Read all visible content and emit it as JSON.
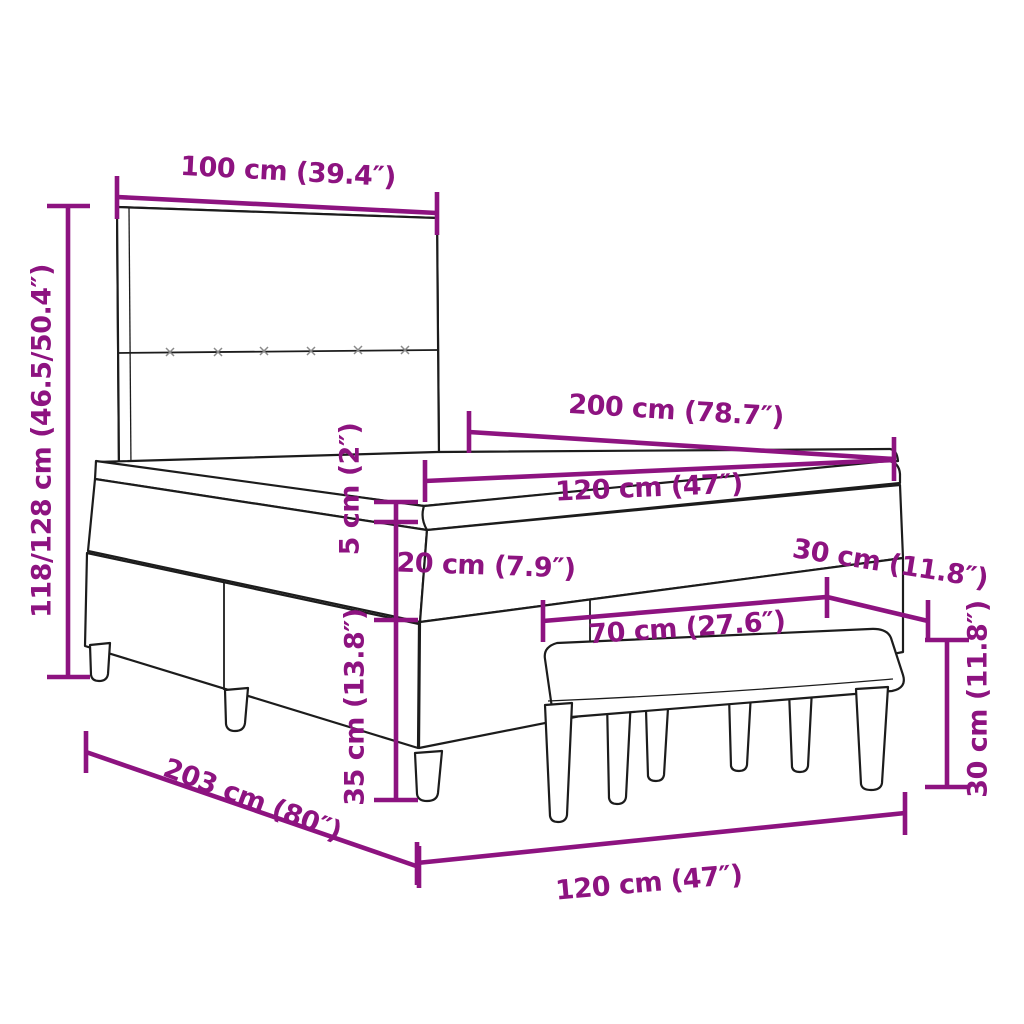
{
  "diagram": {
    "title": "Box spring bed with headboard, mattress topper and bench — dimension diagram",
    "colors": {
      "dimension_accent": "#8d1380",
      "outline": "#1c1c1c",
      "background": "#ffffff"
    },
    "dimensions": {
      "headboard_width": "100 cm (39.4″)",
      "overall_height": "118/128 cm (46.5/50.4″)",
      "bed_length": "200 cm (78.7″)",
      "bed_width": "120 cm (47″)",
      "topper_height": "5 cm (2″)",
      "mattress_height": "20 cm (7.9″)",
      "base_height": "35 cm (13.8″)",
      "bench_depth": "30 cm (11.8″)",
      "bench_length": "70 cm (27.6″)",
      "bench_height": "30 cm (11.8″)",
      "frame_length": "203 cm (80″)",
      "frame_width": "120 cm (47″)"
    }
  }
}
